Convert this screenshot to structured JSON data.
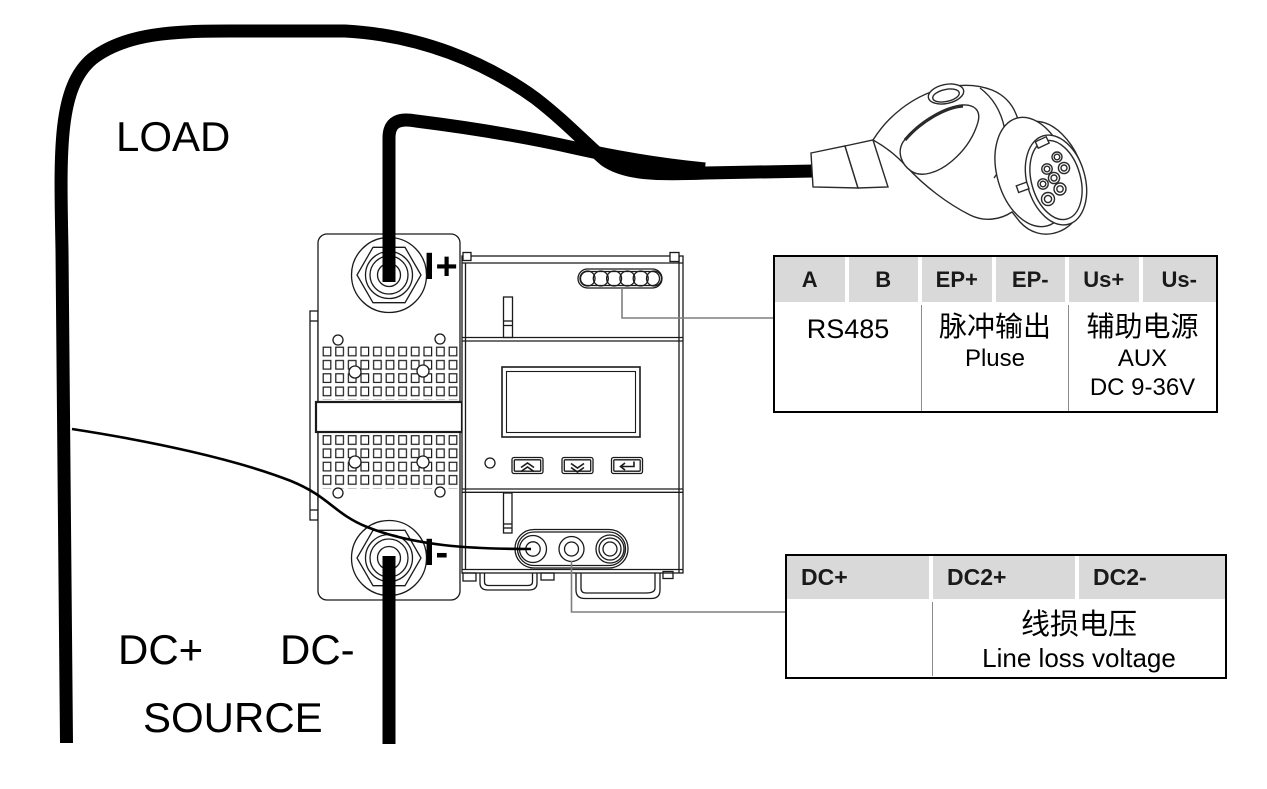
{
  "diagram": {
    "labels": {
      "load": "LOAD",
      "source": "SOURCE",
      "source_dc_plus": "DC+",
      "source_dc_minus": "DC-",
      "shunt_terminal_positive": "I+",
      "shunt_terminal_negative": "I-"
    },
    "tables": {
      "top": {
        "headers": [
          "A",
          "B",
          "EP+",
          "EP-",
          "Us+",
          "Us-"
        ],
        "cells": [
          {
            "lines": [
              "RS485"
            ]
          },
          {
            "lines": [
              "脉冲输出",
              "Pluse"
            ]
          },
          {
            "lines": [
              "辅助电源",
              "AUX",
              "DC 9-36V"
            ]
          }
        ]
      },
      "bottom": {
        "headers": [
          "DC+",
          "DC2+",
          "DC2-"
        ],
        "cells": [
          {
            "lines": []
          },
          {
            "lines": [
              "线损电压",
              "Line loss voltage"
            ]
          }
        ]
      }
    },
    "colors": {
      "background": "#ffffff",
      "line_art": "#1a1a1a",
      "cable": "#000000",
      "table_header_bg": "#d9d9d9",
      "table_outer_border": "#000000",
      "table_grid_line": "#8c8c8c",
      "leader_line": "#7f7f7f"
    },
    "icons": [
      "up-arrows-icon",
      "down-arrows-icon",
      "enter-arrow-icon",
      "led-indicator",
      "ev-connector",
      "shunt-hex-terminal"
    ]
  }
}
